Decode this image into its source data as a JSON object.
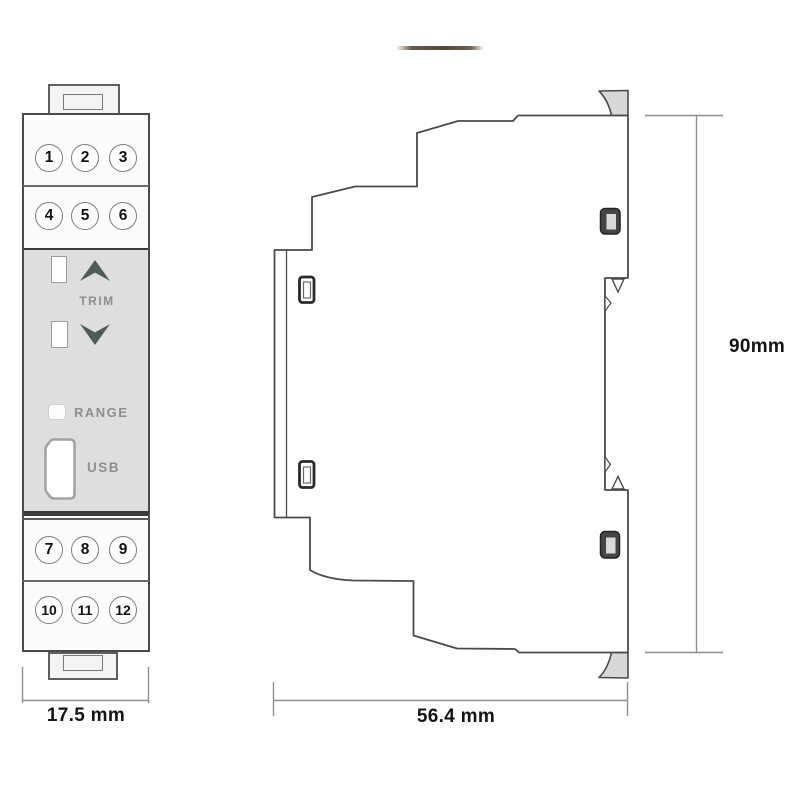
{
  "front_view": {
    "terminals": [
      "1",
      "2",
      "3",
      "4",
      "5",
      "6",
      "7",
      "8",
      "9",
      "10",
      "11",
      "12"
    ],
    "trim_label": "TRIM",
    "range_label": "RANGE",
    "usb_label": "USB"
  },
  "dimensions": {
    "front_width": "17.5 mm",
    "side_depth": "56.4 mm",
    "height": "90mm"
  },
  "colors": {
    "outline": "#4a4a4a",
    "panel_gray": "#dedfdc",
    "arrow_green": "#4d5c54",
    "label_gray": "#8e8e8e",
    "dimension_line": "#909090",
    "clip_tab_fill": "#d8d8d6"
  }
}
